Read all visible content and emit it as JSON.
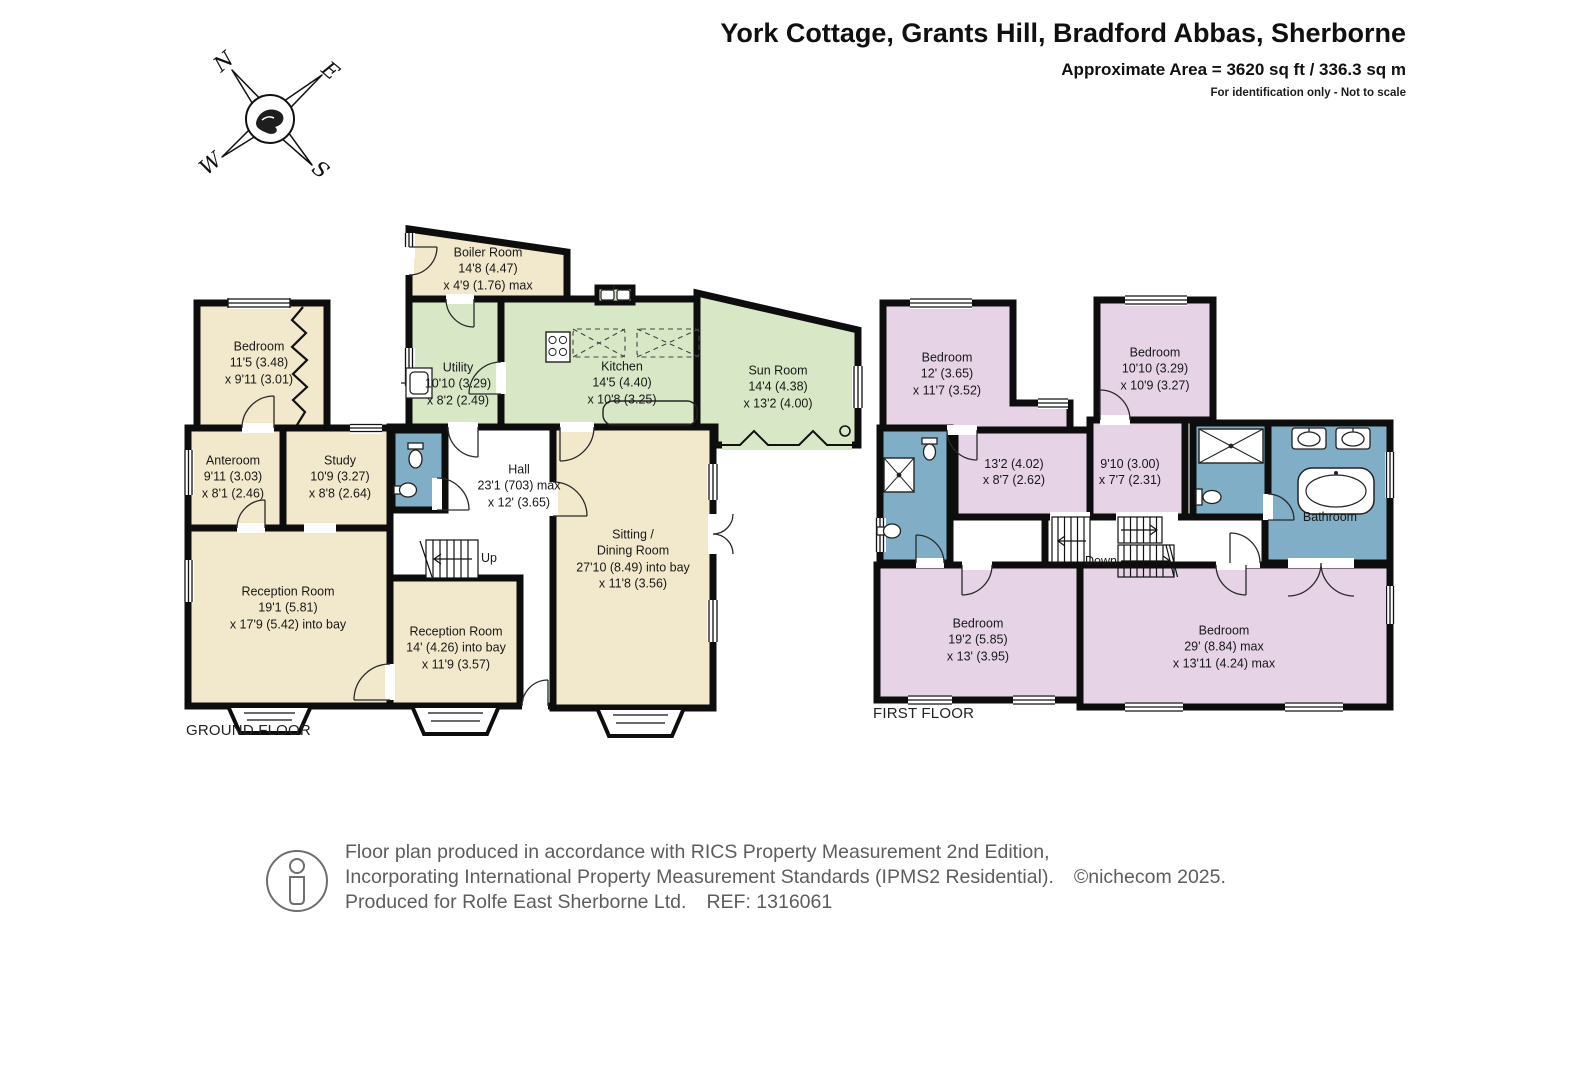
{
  "header": {
    "title": "York Cottage,  Grants Hill, Bradford Abbas, Sherborne",
    "area": "Approximate Area = 3620 sq ft / 336.3 sq m",
    "disclaimer": "For identification only - Not to scale"
  },
  "compass": {
    "north": "N",
    "east": "E",
    "south": "S",
    "west": "W"
  },
  "ground_floor": {
    "title": "GROUND FLOOR",
    "stairs_label": "Up",
    "rooms": {
      "boiler": {
        "lines": [
          "Boiler Room",
          "14'8 (4.47)",
          "x 4'9 (1.76) max"
        ]
      },
      "bedroom": {
        "lines": [
          "Bedroom",
          "11'5 (3.48)",
          "x 9'11 (3.01)"
        ]
      },
      "utility": {
        "lines": [
          "Utility",
          "10'10 (3.29)",
          "x 8'2 (2.49)"
        ]
      },
      "kitchen": {
        "lines": [
          "Kitchen",
          "14'5 (4.40)",
          "x 10'8 (3.25)"
        ]
      },
      "sun_room": {
        "lines": [
          "Sun Room",
          "14'4 (4.38)",
          "x 13'2 (4.00)"
        ]
      },
      "anteroom": {
        "lines": [
          "Anteroom",
          "9'11 (3.03)",
          "x 8'1 (2.46)"
        ]
      },
      "study": {
        "lines": [
          "Study",
          "10'9 (3.27)",
          "x 8'8 (2.64)"
        ]
      },
      "hall": {
        "lines": [
          "Hall",
          "23'1 (703) max",
          "x 12' (3.65)"
        ]
      },
      "sitting_dining": {
        "lines": [
          "Sitting /",
          "Dining Room",
          "27'10 (8.49) into bay",
          "x 11'8 (3.56)"
        ]
      },
      "reception_1": {
        "lines": [
          "Reception Room",
          "19'1 (5.81)",
          "x 17'9 (5.42) into bay"
        ]
      },
      "reception_2": {
        "lines": [
          "Reception Room",
          "14' (4.26) into bay",
          "x 11'9 (3.57)"
        ]
      }
    }
  },
  "first_floor": {
    "title": "FIRST FLOOR",
    "stairs_label": "Down",
    "rooms": {
      "bedroom_tl": {
        "lines": [
          "Bedroom",
          "12' (3.65)",
          "x 11'7 (3.52)"
        ]
      },
      "bedroom_tr": {
        "lines": [
          "Bedroom",
          "10'10 (3.29)",
          "x 10'9 (3.27)"
        ]
      },
      "landing_1": {
        "lines": [
          "13'2 (4.02)",
          "x 8'7 (2.62)"
        ]
      },
      "landing_2": {
        "lines": [
          "9'10 (3.00)",
          "x 7'7 (2.31)"
        ]
      },
      "bathroom": {
        "lines": [
          "Bathroom"
        ]
      },
      "bedroom_bl": {
        "lines": [
          "Bedroom",
          "19'2 (5.85)",
          "x 13' (3.95)"
        ]
      },
      "bedroom_br": {
        "lines": [
          "Bedroom",
          "29' (8.84) max",
          "x 13'11 (4.24) max"
        ]
      }
    }
  },
  "footer": {
    "line1": "Floor plan produced in accordance with RICS Property Measurement 2nd Edition,",
    "line2": "Incorporating International Property Measurement Standards (IPMS2 Residential).",
    "copyright": "©nichecom 2025.",
    "line3": "Produced for Rolfe East Sherborne Ltd.",
    "ref": "REF: 1316061"
  },
  "colors": {
    "room_cream": "#F2E9CC",
    "room_green": "#D8E8C6",
    "room_pink": "#E6D3E6",
    "room_blue": "#7FAEC6",
    "wall": "#0d0d0d",
    "footer_text": "#5d5d5d"
  }
}
